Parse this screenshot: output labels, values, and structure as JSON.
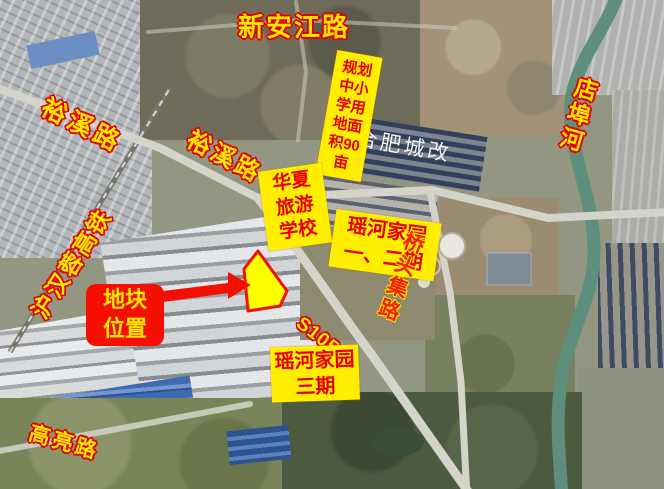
{
  "labels": {
    "xinanjiang_road": {
      "text": "新安江路"
    },
    "yuxi_road_west": {
      "text": "裕溪路"
    },
    "yuxi_road_mid": {
      "text": "裕溪路"
    },
    "school_plan": {
      "full": "规划中小学用地面积90亩",
      "lines": [
        "规划",
        "中小",
        "学用",
        "地面",
        "积90",
        "亩"
      ]
    },
    "hefei_urban_watermark": {
      "text": "合肥城改"
    },
    "dianbu_river": {
      "text": "店埠河"
    },
    "huaxia_school": {
      "full": "华夏旅游学校",
      "lines": [
        "华夏",
        "旅游",
        "学校"
      ]
    },
    "yaohe_phase_1_2": {
      "full": "瑶河家园一、二期",
      "lines": [
        "瑶河家园",
        "一、二期"
      ]
    },
    "qiaotouji_road": {
      "text": "桥头集路"
    },
    "huhanrong_rail": {
      "text": "沪汉蓉高铁"
    },
    "plot_location": {
      "full": "地块位置",
      "lines": [
        "地块",
        "位置"
      ]
    },
    "s105_road": {
      "text": "S105"
    },
    "yaohe_phase_3": {
      "full": "瑶河家园三期",
      "lines": [
        "瑶河家园",
        "三期"
      ]
    },
    "gaoliang_road": {
      "text": "高亮路"
    }
  },
  "colors": {
    "label_yellow": "#ffe600",
    "label_outline_red": "#e00000",
    "box_yellow": "#ffee00",
    "box_text_red": "#e80000",
    "callout_red": "#f40f00",
    "plot_fill": "#ffff00",
    "plot_border": "#f40f00",
    "watermark_white": "#ffffff",
    "river_green": "#5d8f7c"
  }
}
